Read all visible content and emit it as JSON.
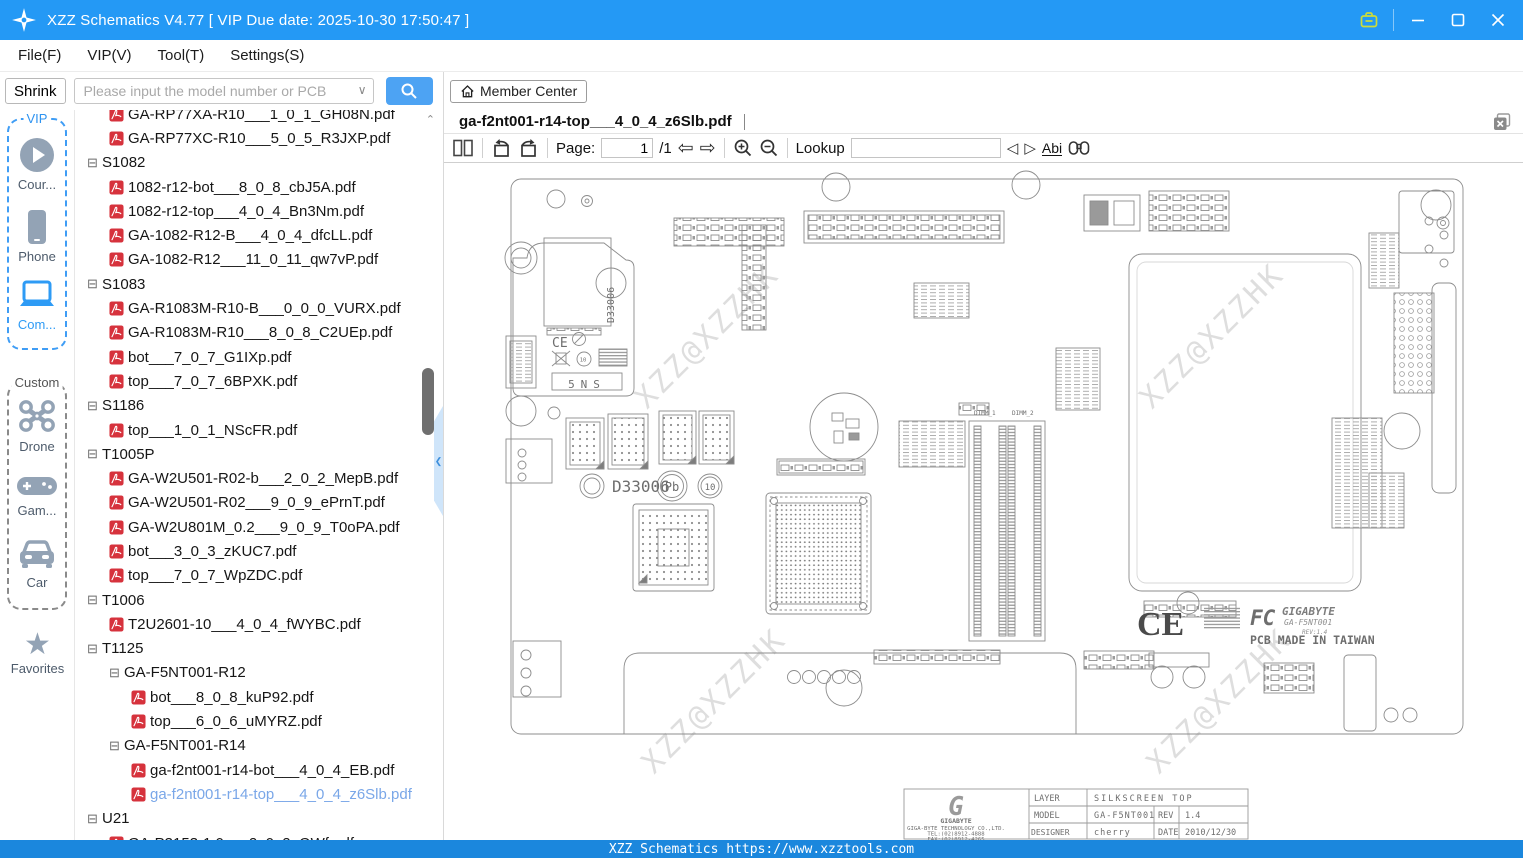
{
  "window": {
    "title": "XZZ Schematics V4.77 [ VIP Due date: 2025-10-30 17:50:47 ]"
  },
  "menu": {
    "items": [
      {
        "label": "File(F)"
      },
      {
        "label": "VIP(V)"
      },
      {
        "label": "Tool(T)"
      },
      {
        "label": "Settings(S)"
      }
    ]
  },
  "search": {
    "shrink_label": "Shrink",
    "placeholder": "Please input the model number or PCB",
    "member_center_label": "Member Center"
  },
  "sidebar": {
    "vip_label": "VIP",
    "custom_label": "Custom",
    "favorites_label": "Favorites",
    "vip_items": [
      {
        "label": "Cour...",
        "icon": "play-icon"
      },
      {
        "label": "Phone",
        "icon": "phone-icon"
      },
      {
        "label": "Com...",
        "icon": "laptop-icon",
        "active": true
      }
    ],
    "custom_items": [
      {
        "label": "Drone",
        "icon": "drone-icon"
      },
      {
        "label": "Gam...",
        "icon": "gamepad-icon"
      },
      {
        "label": "Car",
        "icon": "car-icon"
      }
    ]
  },
  "tree": {
    "items": [
      {
        "type": "file",
        "level": 1,
        "label": "GA-RP77XA-R10___1_0_1_GH08N.pdf"
      },
      {
        "type": "file",
        "level": 1,
        "label": "GA-RP77XC-R10___5_0_5_R3JXP.pdf"
      },
      {
        "type": "folder",
        "level": 0,
        "label": "S1082"
      },
      {
        "type": "file",
        "level": 1,
        "label": "1082-r12-bot___8_0_8_cbJ5A.pdf"
      },
      {
        "type": "file",
        "level": 1,
        "label": "1082-r12-top___4_0_4_Bn3Nm.pdf"
      },
      {
        "type": "file",
        "level": 1,
        "label": "GA-1082-R12-B___4_0_4_dfcLL.pdf"
      },
      {
        "type": "file",
        "level": 1,
        "label": "GA-1082-R12___11_0_11_qw7vP.pdf"
      },
      {
        "type": "folder",
        "level": 0,
        "label": "S1083"
      },
      {
        "type": "file",
        "level": 1,
        "label": "GA-R1083M-R10-B___0_0_0_VURX.pdf"
      },
      {
        "type": "file",
        "level": 1,
        "label": "GA-R1083M-R10___8_0_8_C2UEp.pdf"
      },
      {
        "type": "file",
        "level": 1,
        "label": "bot___7_0_7_G1IXp.pdf"
      },
      {
        "type": "file",
        "level": 1,
        "label": "top___7_0_7_6BPXK.pdf"
      },
      {
        "type": "folder",
        "level": 0,
        "label": "S1186"
      },
      {
        "type": "file",
        "level": 1,
        "label": "top___1_0_1_NScFR.pdf"
      },
      {
        "type": "folder",
        "level": 0,
        "label": "T1005P"
      },
      {
        "type": "file",
        "level": 1,
        "label": "GA-W2U501-R02-b___2_0_2_MepB.pdf"
      },
      {
        "type": "file",
        "level": 1,
        "label": "GA-W2U501-R02___9_0_9_ePrnT.pdf"
      },
      {
        "type": "file",
        "level": 1,
        "label": "GA-W2U801M_0.2___9_0_9_T0oPA.pdf"
      },
      {
        "type": "file",
        "level": 1,
        "label": "bot___3_0_3_zKUC7.pdf"
      },
      {
        "type": "file",
        "level": 1,
        "label": "top___7_0_7_WpZDC.pdf"
      },
      {
        "type": "folder",
        "level": 0,
        "label": "T1006"
      },
      {
        "type": "file",
        "level": 1,
        "label": "T2U2601-10___4_0_4_fWYBC.pdf"
      },
      {
        "type": "folder",
        "level": 0,
        "label": "T1125"
      },
      {
        "type": "folder",
        "level": 1,
        "label": "GA-F5NT001-R12"
      },
      {
        "type": "file",
        "level": 2,
        "label": "bot___8_0_8_kuP92.pdf"
      },
      {
        "type": "file",
        "level": 2,
        "label": "top___6_0_6_uMYRZ.pdf"
      },
      {
        "type": "folder",
        "level": 1,
        "label": "GA-F5NT001-R14"
      },
      {
        "type": "file",
        "level": 2,
        "label": "ga-f2nt001-r14-bot___4_0_4_EB.pdf"
      },
      {
        "type": "file",
        "level": 2,
        "label": "ga-f2nt001-r14-top___4_0_4_z6Slb.pdf",
        "selected": true
      },
      {
        "type": "folder",
        "level": 0,
        "label": "U21"
      },
      {
        "type": "file",
        "level": 1,
        "label": "GA-P3153-1.0___2_0_2_QWf.pdf"
      }
    ]
  },
  "viewer": {
    "tab_title": "ga-f2nt001-r14-top___4_0_4_z6Slb.pdf",
    "toolbar": {
      "page_label": "Page:",
      "page_value": "1",
      "page_total": "/1",
      "lookup_label": "Lookup",
      "lookup_value": "",
      "abi_label": "Abi"
    }
  },
  "pcb": {
    "watermark": "XZZ@XZZHK",
    "labels": {
      "d33006": "D33006",
      "sns": "5NS",
      "ce": "CE",
      "pb": "Pb",
      "ten": "10",
      "fcc": "FC",
      "gigabyte": "GIGABYTE",
      "model_stylized": "GA-F5NT001",
      "rev_small": "REV:1.4",
      "made_in": "PCB MADE IN TAIWAN",
      "dimm1": "DIMM_1",
      "dimm2": "DIMM_2"
    },
    "title_block": {
      "logo_g": "G",
      "logo_text": "GIGABYTE",
      "company": "GIGA-BYTE TECHNOLOGY CO.,LTD.",
      "tel": "TEL:(02)8912-4888",
      "fax": "FAX:(02)8912-4265",
      "layer_label": "LAYER",
      "layer_value": "SILKSCREEN TOP",
      "model_label": "MODEL",
      "model_value": "GA-F5NT001",
      "rev_label": "REV",
      "rev_value": "1.4",
      "designer_label": "DESIGNER",
      "designer_value": "cherry",
      "date_label": "DATE",
      "date_value": "2010/12/30"
    }
  },
  "statusbar": {
    "text": "XZZ Schematics https://www.xzztools.com"
  }
}
